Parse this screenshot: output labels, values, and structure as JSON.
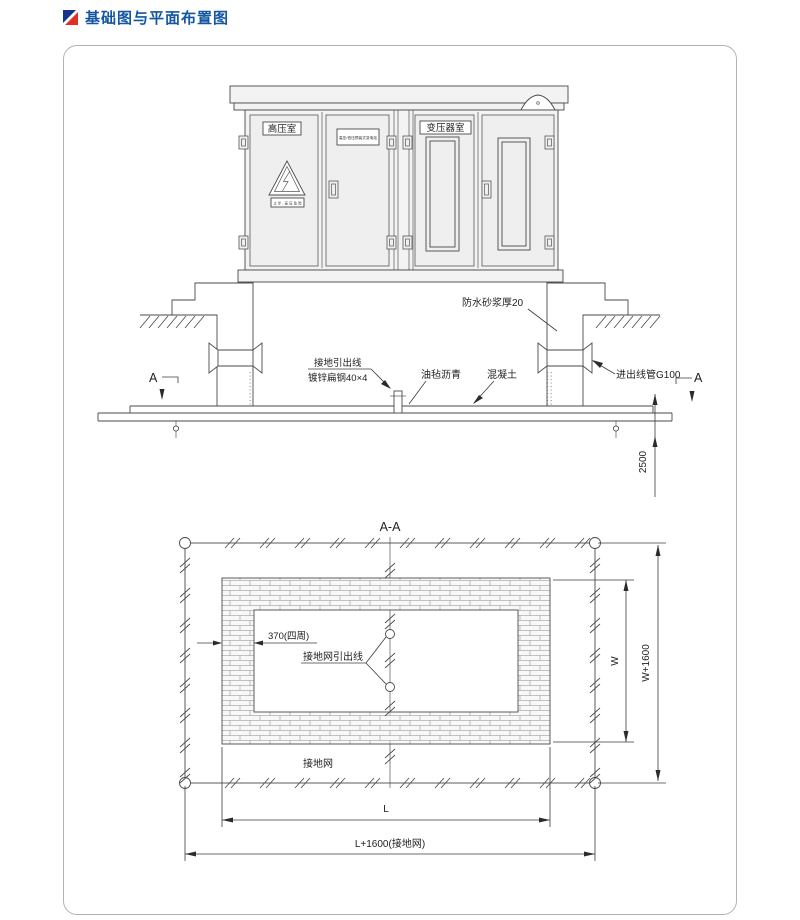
{
  "page": {
    "title": "基础图与平面布置图"
  },
  "elevation": {
    "room_hv": "高压室",
    "room_transformer": "变压器室",
    "nameplate": "高压/低压预装式变电站",
    "warning": "止步,高压危险",
    "mortar": "防水砂浆厚20",
    "ground_lead_line1": "接地引出线",
    "ground_lead_line2": "镀锌扁钢40×4",
    "asphalt": "油毡沥青",
    "concrete": "混凝土",
    "conduit": "进出线管G100",
    "section_a": "A",
    "dim_2500": "2500"
  },
  "plan": {
    "section_title": "A-A",
    "wall_thickness": "370(四周)",
    "grid_lead": "接地网引出线",
    "grid_label": "接地网",
    "dim_w": "W",
    "dim_w_total": "W+1600",
    "dim_l": "L",
    "dim_l_total": "L+1600(接地网)"
  },
  "colors": {
    "title_blue": "#1456a0",
    "icon_blue": "#16338e",
    "icon_red": "#e03026",
    "line": "#4a4a4a"
  }
}
